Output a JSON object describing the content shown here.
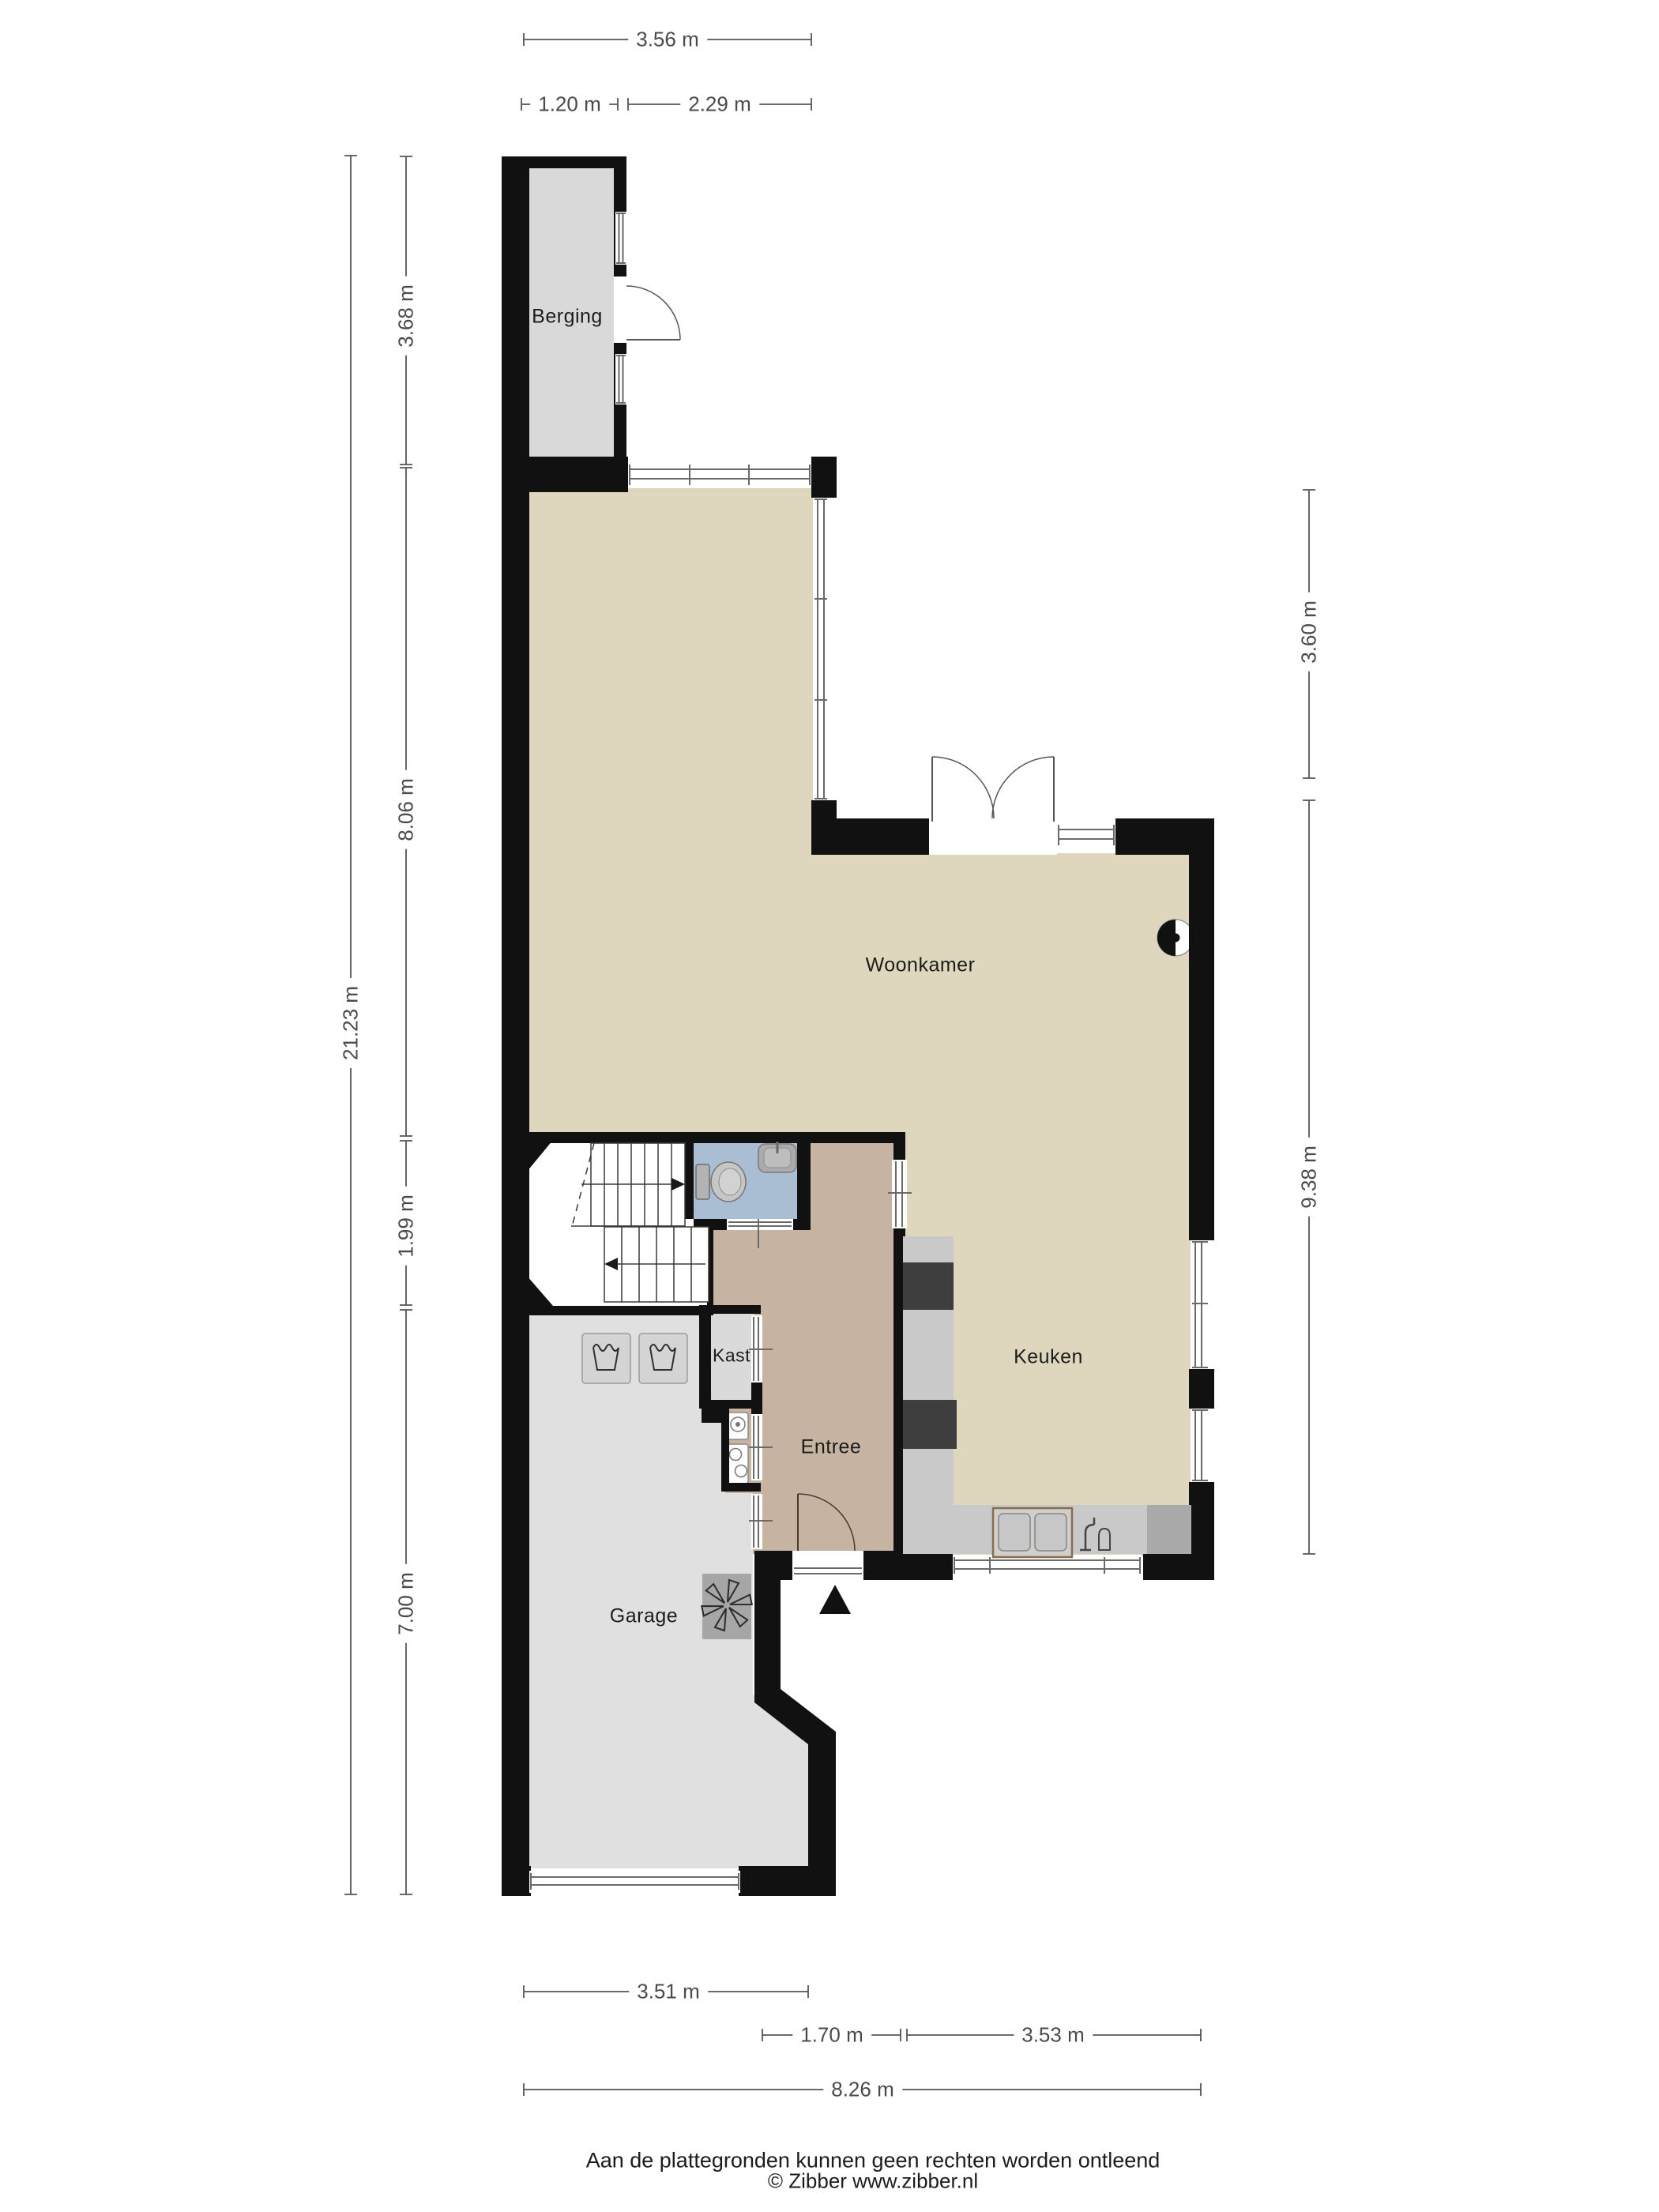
{
  "rooms": {
    "berging": {
      "label": "Berging"
    },
    "woonkamer": {
      "label": "Woonkamer"
    },
    "keuken": {
      "label": "Keuken"
    },
    "kast": {
      "label": "Kast"
    },
    "entree": {
      "label": "Entree"
    },
    "garage": {
      "label": "Garage"
    }
  },
  "dimensions": {
    "top_total": "3.56 m",
    "top_left": "1.20 m",
    "top_right": "2.29 m",
    "left_berging": "3.68 m",
    "left_woonkamer": "8.06 m",
    "left_total": "21.23 m",
    "left_hal": "1.99 m",
    "left_garage": "7.00 m",
    "right_top": "3.60 m",
    "right_bottom": "9.38 m",
    "bottom_garage": "3.51 m",
    "bottom_entree": "1.70 m",
    "bottom_keuken": "3.53 m",
    "bottom_total": "8.26 m"
  },
  "footer": {
    "disclaimer": "Aan de plattegronden kunnen geen rechten worden ontleend",
    "copyright": "© Zibber www.zibber.nl"
  },
  "colors": {
    "wall": "#111111",
    "floor_living": "#ded7bd",
    "floor_berging": "#d9d9d9",
    "floor_garage": "#e0e0e0",
    "floor_toilet": "#a9bdd3",
    "floor_entree": "#c6b3a2",
    "floor_kast": "#dadada",
    "counter": "#c9c9c9",
    "appliance_dark": "#3e3e3e",
    "appliance_medium": "#a9a9a9",
    "dimension": "#4a4a4a",
    "text": "#1c1c1c"
  }
}
